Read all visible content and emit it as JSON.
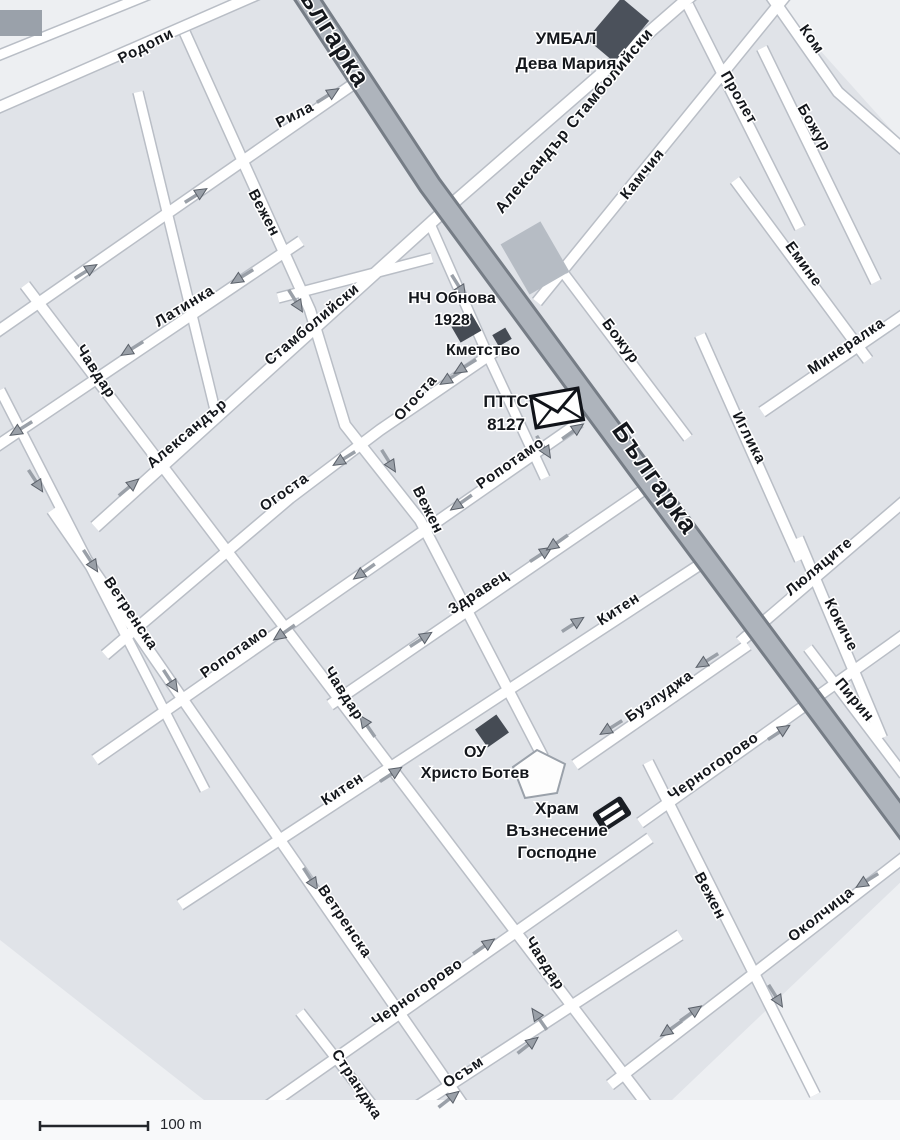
{
  "map": {
    "width": 900,
    "height": 1140,
    "colors": {
      "base": "#e0e3e8",
      "light_region": "#edeff2",
      "street_fill": "#ffffff",
      "street_casing": "#b9bec6",
      "boulevard_fill": "#aeb4bc",
      "boulevard_casing": "#767d86",
      "label": "#14171c",
      "arrow_fill": "#9aa0a8",
      "arrow_outline": "#5a6069",
      "margin": "#f8f9fa",
      "scale": "#23262b"
    },
    "light_regions": [
      [
        [
          0,
          0
        ],
        [
          255,
          0
        ],
        [
          0,
          102
        ]
      ],
      [
        [
          775,
          0
        ],
        [
          905,
          0
        ],
        [
          905,
          145
        ]
      ],
      [
        [
          630,
          1140
        ],
        [
          905,
          878
        ],
        [
          905,
          1140
        ]
      ],
      [
        [
          0,
          940
        ],
        [
          255,
          1140
        ],
        [
          0,
          1140
        ]
      ]
    ],
    "boulevard": {
      "name": "Българка",
      "path": [
        [
          295,
          -20
        ],
        [
          430,
          185
        ],
        [
          640,
          470
        ],
        [
          930,
          860
        ]
      ],
      "labels": [
        {
          "t": "Българка",
          "x": 322,
          "y": 34,
          "a": 58,
          "s": 26
        },
        {
          "t": "Българка",
          "x": 648,
          "y": 483,
          "a": 55,
          "s": 26
        }
      ]
    },
    "streets": [
      {
        "name": "Родопи",
        "w": 10,
        "path": [
          [
            -12,
            112
          ],
          [
            272,
            -12
          ]
        ],
        "labels": [
          {
            "t": "Родопи",
            "x": 148,
            "y": 50,
            "a": -27
          }
        ]
      },
      {
        "name": "",
        "w": 9,
        "path": [
          [
            -8,
            58
          ],
          [
            165,
            -12
          ]
        ],
        "labels": []
      },
      {
        "name": "Рила",
        "w": 10,
        "path": [
          [
            -12,
            338
          ],
          [
            352,
            85
          ]
        ],
        "labels": [
          {
            "t": "Рила",
            "x": 297,
            "y": 119,
            "a": -27
          }
        ]
      },
      {
        "name": "Латинка",
        "w": 10,
        "path": [
          [
            -12,
            452
          ],
          [
            301,
            241
          ]
        ],
        "labels": [
          {
            "t": "Латинка",
            "x": 187,
            "y": 310,
            "a": -31
          }
        ]
      },
      {
        "name": "",
        "w": 9,
        "path": [
          [
            278,
            298
          ],
          [
            432,
            258
          ]
        ],
        "labels": []
      },
      {
        "name": "Александър Стамболийски",
        "w": 11,
        "path": [
          [
            95,
            527
          ],
          [
            445,
            210
          ]
        ],
        "labels": [
          {
            "t": "Александър",
            "x": 190,
            "y": 437,
            "a": -40
          },
          {
            "t": "Стамболийски",
            "x": 315,
            "y": 328,
            "a": -40
          }
        ]
      },
      {
        "name": "Александър Стамболийски",
        "w": 11,
        "path": [
          [
            445,
            210
          ],
          [
            700,
            -12
          ]
        ],
        "labels": [
          {
            "t": "Александър Стамболийски",
            "x": 578,
            "y": 124,
            "a": -50,
            "s": 16
          }
        ]
      },
      {
        "name": "Огоста",
        "w": 10,
        "path": [
          [
            105,
            655
          ],
          [
            290,
            498
          ],
          [
            380,
            430
          ],
          [
            497,
            350
          ]
        ],
        "labels": [
          {
            "t": "Огоста",
            "x": 287,
            "y": 496,
            "a": -35
          },
          {
            "t": "Огоста",
            "x": 419,
            "y": 401,
            "a": -48
          }
        ]
      },
      {
        "name": "Ропотамо",
        "w": 10,
        "path": [
          [
            95,
            760
          ],
          [
            580,
            422
          ]
        ],
        "labels": [
          {
            "t": "Ропотамо",
            "x": 237,
            "y": 656,
            "a": -35
          },
          {
            "t": "Ропотамо",
            "x": 513,
            "y": 467,
            "a": -35
          }
        ]
      },
      {
        "name": "Здравец",
        "w": 10,
        "path": [
          [
            330,
            705
          ],
          [
            648,
            487
          ]
        ],
        "labels": [
          {
            "t": "Здравец",
            "x": 481,
            "y": 596,
            "a": -33
          }
        ]
      },
      {
        "name": "Китен",
        "w": 10,
        "path": [
          [
            180,
            905
          ],
          [
            707,
            560
          ]
        ],
        "labels": [
          {
            "t": "Китен",
            "x": 345,
            "y": 793,
            "a": -33
          },
          {
            "t": "Китен",
            "x": 621,
            "y": 613,
            "a": -33
          }
        ]
      },
      {
        "name": "Бузлуджа",
        "w": 10,
        "path": [
          [
            575,
            765
          ],
          [
            748,
            645
          ]
        ],
        "labels": [
          {
            "t": "Бузлуджа",
            "x": 662,
            "y": 700,
            "a": -35
          }
        ]
      },
      {
        "name": "Люляците",
        "w": 10,
        "path": [
          [
            740,
            642
          ],
          [
            908,
            498
          ]
        ],
        "labels": [
          {
            "t": "Люляците",
            "x": 822,
            "y": 570,
            "a": -40
          }
        ]
      },
      {
        "name": "Черногорово",
        "w": 10,
        "path": [
          [
            640,
            823
          ],
          [
            908,
            632
          ]
        ],
        "labels": [
          {
            "t": "Черногорово",
            "x": 716,
            "y": 770,
            "a": -35
          }
        ]
      },
      {
        "name": "Околчица",
        "w": 10,
        "path": [
          [
            610,
            1085
          ],
          [
            907,
            855
          ]
        ],
        "labels": [
          {
            "t": "Околчица",
            "x": 824,
            "y": 918,
            "a": -38
          }
        ]
      },
      {
        "name": "Черногорово",
        "w": 10,
        "path": [
          [
            265,
            1108
          ],
          [
            650,
            838
          ]
        ],
        "labels": [
          {
            "t": "Черногорово",
            "x": 420,
            "y": 996,
            "a": -35
          }
        ]
      },
      {
        "name": "Осъм",
        "w": 10,
        "path": [
          [
            355,
            1147
          ],
          [
            680,
            935
          ]
        ],
        "labels": [
          {
            "t": "Осъм",
            "x": 466,
            "y": 1076,
            "a": -33
          }
        ]
      },
      {
        "name": "Камчия",
        "w": 10,
        "path": [
          [
            537,
            302
          ],
          [
            792,
            -12
          ]
        ],
        "labels": [
          {
            "t": "Камчия",
            "x": 646,
            "y": 177,
            "a": -51
          }
        ]
      },
      {
        "name": "Минералка",
        "w": 10,
        "path": [
          [
            762,
            412
          ],
          [
            908,
            312
          ]
        ],
        "labels": [
          {
            "t": "Минералка",
            "x": 849,
            "y": 350,
            "a": -34
          }
        ]
      },
      {
        "name": "Чавдар",
        "w": 10,
        "path": [
          [
            25,
            285
          ],
          [
            660,
            1122
          ]
        ],
        "labels": [
          {
            "t": "Чавдар",
            "x": 92,
            "y": 374,
            "a": 57
          },
          {
            "t": "Чавдар",
            "x": 340,
            "y": 696,
            "a": 57
          },
          {
            "t": "Чавдар",
            "x": 541,
            "y": 966,
            "a": 57
          }
        ]
      },
      {
        "name": "Вежен",
        "w": 10,
        "path": [
          [
            185,
            33
          ],
          [
            310,
            310
          ],
          [
            345,
            425
          ],
          [
            420,
            520
          ],
          [
            543,
            757
          ]
        ],
        "labels": [
          {
            "t": "Вежен",
            "x": 260,
            "y": 215,
            "a": 62
          },
          {
            "t": "Вежен",
            "x": 424,
            "y": 512,
            "a": 63
          }
        ]
      },
      {
        "name": "",
        "w": 9,
        "path": [
          [
            430,
            224
          ],
          [
            490,
            360
          ],
          [
            545,
            478
          ]
        ],
        "labels": []
      },
      {
        "name": "Ветренска",
        "w": 10,
        "path": [
          [
            52,
            510
          ],
          [
            492,
            1147
          ]
        ],
        "labels": [
          {
            "t": "Ветренска",
            "x": 127,
            "y": 616,
            "a": 56
          },
          {
            "t": "Ветренска",
            "x": 341,
            "y": 924,
            "a": 56
          }
        ]
      },
      {
        "name": "Странджа",
        "w": 9,
        "path": [
          [
            300,
            1012
          ],
          [
            405,
            1147
          ]
        ],
        "labels": [
          {
            "t": "Странджа",
            "x": 353,
            "y": 1087,
            "a": 57
          }
        ]
      },
      {
        "name": "",
        "w": 9,
        "path": [
          [
            0,
            390
          ],
          [
            205,
            790
          ]
        ],
        "labels": []
      },
      {
        "name": "",
        "w": 9,
        "path": [
          [
            138,
            92
          ],
          [
            215,
            410
          ]
        ],
        "labels": []
      },
      {
        "name": "Пролет",
        "w": 10,
        "path": [
          [
            688,
            5
          ],
          [
            800,
            228
          ]
        ],
        "labels": [
          {
            "t": "Пролет",
            "x": 735,
            "y": 100,
            "a": 60
          }
        ]
      },
      {
        "name": "Ком",
        "w": 10,
        "path": [
          [
            768,
            -8
          ],
          [
            838,
            92
          ],
          [
            904,
            150
          ]
        ],
        "labels": [
          {
            "t": "Ком",
            "x": 808,
            "y": 42,
            "a": 55
          }
        ]
      },
      {
        "name": "Божур",
        "w": 10,
        "path": [
          [
            762,
            48
          ],
          [
            876,
            282
          ]
        ],
        "labels": [
          {
            "t": "Божур",
            "x": 810,
            "y": 130,
            "a": 60
          }
        ]
      },
      {
        "name": "Божур",
        "w": 9,
        "path": [
          [
            565,
            275
          ],
          [
            688,
            438
          ]
        ],
        "labels": [
          {
            "t": "Божур",
            "x": 617,
            "y": 344,
            "a": 53
          }
        ]
      },
      {
        "name": "Емине",
        "w": 10,
        "path": [
          [
            735,
            180
          ],
          [
            868,
            360
          ]
        ],
        "labels": [
          {
            "t": "Емине",
            "x": 800,
            "y": 267,
            "a": 54
          }
        ]
      },
      {
        "name": "Иглика",
        "w": 10,
        "path": [
          [
            700,
            335
          ],
          [
            800,
            560
          ]
        ],
        "labels": [
          {
            "t": "Иглика",
            "x": 745,
            "y": 440,
            "a": 63
          }
        ]
      },
      {
        "name": "Кокиче",
        "w": 10,
        "path": [
          [
            798,
            538
          ],
          [
            882,
            738
          ]
        ],
        "labels": [
          {
            "t": "Кокиче",
            "x": 837,
            "y": 627,
            "a": 63
          }
        ]
      },
      {
        "name": "Пирин",
        "w": 9,
        "path": [
          [
            808,
            648
          ],
          [
            904,
            775
          ]
        ],
        "labels": [
          {
            "t": "Пирин",
            "x": 851,
            "y": 703,
            "a": 50
          }
        ]
      },
      {
        "name": "Вежен",
        "w": 10,
        "path": [
          [
            648,
            762
          ],
          [
            815,
            1095
          ]
        ],
        "labels": [
          {
            "t": "Вежен",
            "x": 706,
            "y": 898,
            "a": 62
          }
        ]
      }
    ],
    "arrows": [
      [
        327,
        96,
        -32
      ],
      [
        195,
        196,
        -32
      ],
      [
        85,
        272,
        -32
      ],
      [
        243,
        276,
        148
      ],
      [
        133,
        348,
        148
      ],
      [
        22,
        428,
        148
      ],
      [
        128,
        488,
        -40
      ],
      [
        295,
        300,
        58
      ],
      [
        388,
        460,
        58
      ],
      [
        345,
        458,
        148
      ],
      [
        452,
        377,
        148
      ],
      [
        466,
        366,
        148
      ],
      [
        458,
        285,
        58
      ],
      [
        543,
        446,
        58
      ],
      [
        285,
        632,
        145
      ],
      [
        365,
        571,
        145
      ],
      [
        462,
        502,
        145
      ],
      [
        572,
        432,
        -35
      ],
      [
        420,
        640,
        -33
      ],
      [
        540,
        555,
        -33
      ],
      [
        558,
        542,
        145
      ],
      [
        390,
        775,
        -33
      ],
      [
        572,
        625,
        -33
      ],
      [
        708,
        660,
        148
      ],
      [
        612,
        727,
        148
      ],
      [
        778,
        733,
        -33
      ],
      [
        868,
        880,
        148
      ],
      [
        775,
        995,
        58
      ],
      [
        672,
        1028,
        145
      ],
      [
        690,
        1014,
        -35
      ],
      [
        448,
        1100,
        -38
      ],
      [
        527,
        1046,
        -38
      ],
      [
        483,
        947,
        -35
      ],
      [
        90,
        560,
        57
      ],
      [
        170,
        680,
        57
      ],
      [
        310,
        878,
        57
      ],
      [
        368,
        727,
        -125
      ],
      [
        540,
        1020,
        -125
      ],
      [
        35,
        480,
        57
      ]
    ],
    "buildings": [
      {
        "x": 618,
        "y": 30,
        "w": 54,
        "h": 36,
        "a": -50,
        "c": "#4b515b"
      },
      {
        "x": 466,
        "y": 328,
        "w": 24,
        "h": 20,
        "a": -30,
        "c": "#454b54"
      },
      {
        "x": 502,
        "y": 337,
        "w": 15,
        "h": 13,
        "a": -30,
        "c": "#454b54"
      },
      {
        "x": 492,
        "y": 731,
        "w": 26,
        "h": 22,
        "a": -35,
        "c": "#454b54"
      },
      {
        "x": 535,
        "y": 258,
        "w": 46,
        "h": 58,
        "a": -30,
        "c": "#b6bcc4"
      },
      {
        "x": 21,
        "y": 23,
        "w": 42,
        "h": 26,
        "a": 0,
        "c": "#9aa1aa"
      }
    ],
    "church_icon": {
      "x": 540,
      "y": 777,
      "points": "-27,-10 -3,-27 25,-13 17,16 -15,21"
    },
    "transport_icon": {
      "x": 612,
      "y": 814,
      "a": -33
    },
    "post_icon": {
      "x": 557,
      "y": 408,
      "a": -10
    },
    "pois": [
      {
        "lines": [
          "УМБАЛ",
          "Дева Мария"
        ],
        "x": 566,
        "y": 44,
        "lh": 25,
        "s": 17
      },
      {
        "lines": [
          "НЧ Обнова",
          "1928"
        ],
        "x": 452,
        "y": 303,
        "lh": 22,
        "s": 16
      },
      {
        "lines": [
          "Кметство"
        ],
        "x": 483,
        "y": 355,
        "lh": 22,
        "s": 16
      },
      {
        "lines": [
          "ПТТС",
          "8127"
        ],
        "x": 506,
        "y": 407,
        "lh": 23,
        "s": 17
      },
      {
        "lines": [
          "ОУ",
          "Христо Ботев"
        ],
        "x": 475,
        "y": 757,
        "lh": 21,
        "s": 16
      },
      {
        "lines": [
          "Храм",
          "Възнесение",
          "Господне"
        ],
        "x": 557,
        "y": 814,
        "lh": 22,
        "s": 17
      }
    ],
    "scale_bar": {
      "x1": 40,
      "x2": 148,
      "y": 1126,
      "label": "100 m"
    }
  }
}
